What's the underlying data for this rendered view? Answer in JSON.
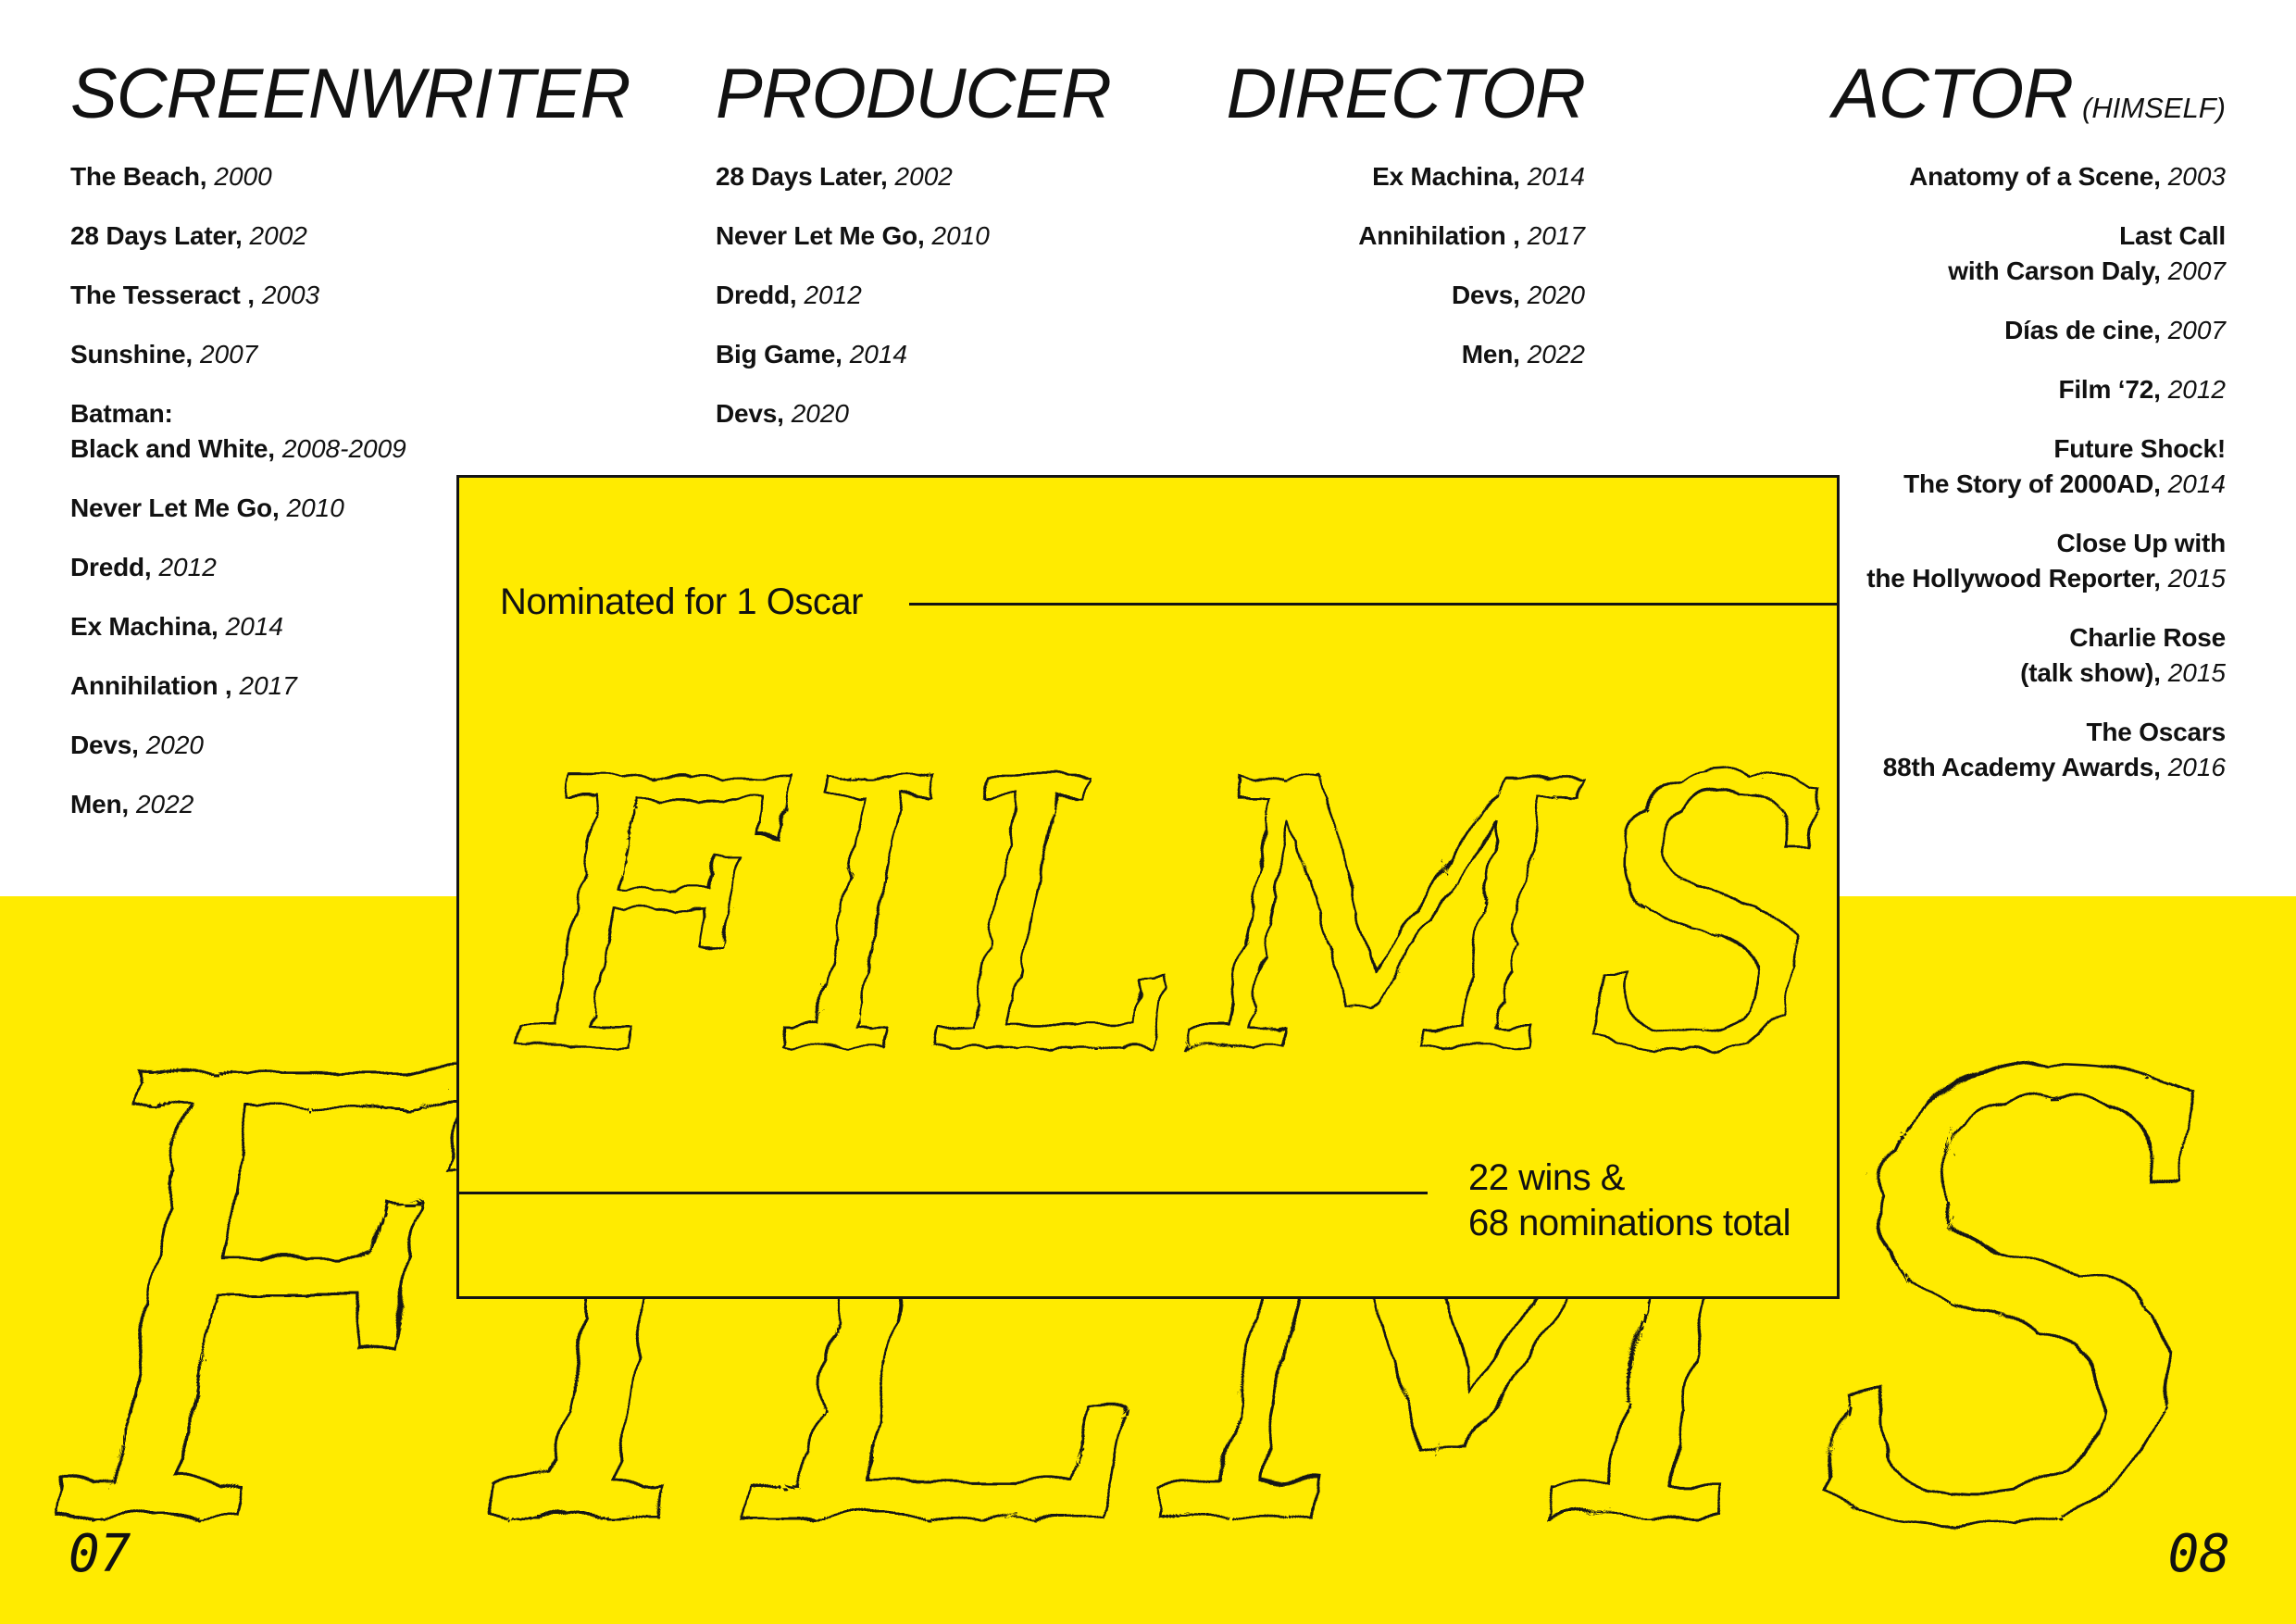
{
  "colors": {
    "yellow": "#FFEB00",
    "ink": "#141414"
  },
  "films_word": "FILMS",
  "columns": [
    {
      "title": "SCREENWRITER",
      "title_suffix": "",
      "align": "left",
      "items": [
        {
          "lines": [
            "The Beach,"
          ],
          "year": "2000"
        },
        {
          "lines": [
            "28 Days Later,"
          ],
          "year": "2002"
        },
        {
          "lines": [
            "The Tesseract ,"
          ],
          "year": "2003"
        },
        {
          "lines": [
            "Sunshine,"
          ],
          "year": "2007"
        },
        {
          "lines": [
            "Batman:",
            "Black and White,"
          ],
          "year": "2008-2009"
        },
        {
          "lines": [
            "Never Let Me Go,"
          ],
          "year": "2010"
        },
        {
          "lines": [
            "Dredd,"
          ],
          "year": "2012"
        },
        {
          "lines": [
            "Ex Machina,"
          ],
          "year": "2014"
        },
        {
          "lines": [
            "Annihilation ,"
          ],
          "year": "2017"
        },
        {
          "lines": [
            "Devs,"
          ],
          "year": "2020"
        },
        {
          "lines": [
            "Men,"
          ],
          "year": "2022"
        }
      ]
    },
    {
      "title": "PRODUCER",
      "title_suffix": "",
      "align": "left",
      "items": [
        {
          "lines": [
            "28 Days Later,"
          ],
          "year": "2002"
        },
        {
          "lines": [
            "Never Let Me Go,"
          ],
          "year": "2010"
        },
        {
          "lines": [
            "Dredd,"
          ],
          "year": "2012"
        },
        {
          "lines": [
            "Big Game,"
          ],
          "year": "2014"
        },
        {
          "lines": [
            "Devs,"
          ],
          "year": "2020"
        }
      ]
    },
    {
      "title": "DIRECTOR",
      "title_suffix": "",
      "align": "right",
      "items": [
        {
          "lines": [
            "Ex Machina,"
          ],
          "year": "2014"
        },
        {
          "lines": [
            "Annihilation ,"
          ],
          "year": "2017"
        },
        {
          "lines": [
            "Devs,"
          ],
          "year": "2020"
        },
        {
          "lines": [
            "Men,"
          ],
          "year": "2022"
        }
      ]
    },
    {
      "title": "ACTOR",
      "title_suffix": "(HIMSELF)",
      "align": "right",
      "items": [
        {
          "lines": [
            "Anatomy of a Scene,"
          ],
          "year": "2003"
        },
        {
          "lines": [
            "Last Call",
            "with Carson Daly,"
          ],
          "year": "2007"
        },
        {
          "lines": [
            "Días de cine,"
          ],
          "year": "2007"
        },
        {
          "lines": [
            "Film ‘72,"
          ],
          "year": "2012"
        },
        {
          "lines": [
            "Future Shock!",
            "The Story of 2000AD,"
          ],
          "year": "2014"
        },
        {
          "lines": [
            "Close Up with",
            "the Hollywood Reporter,"
          ],
          "year": "2015"
        },
        {
          "lines": [
            "Charlie Rose",
            "(talk show),"
          ],
          "year": "2015"
        },
        {
          "lines": [
            "The Oscars",
            "88th Academy Awards,"
          ],
          "year": "2016"
        }
      ]
    }
  ],
  "panel": {
    "nominated_label": "Nominated for 1 Oscar",
    "wins_line1": "22 wins &",
    "wins_line2": "68 nominations total"
  },
  "page_numbers": {
    "left": "07",
    "right": "08"
  }
}
